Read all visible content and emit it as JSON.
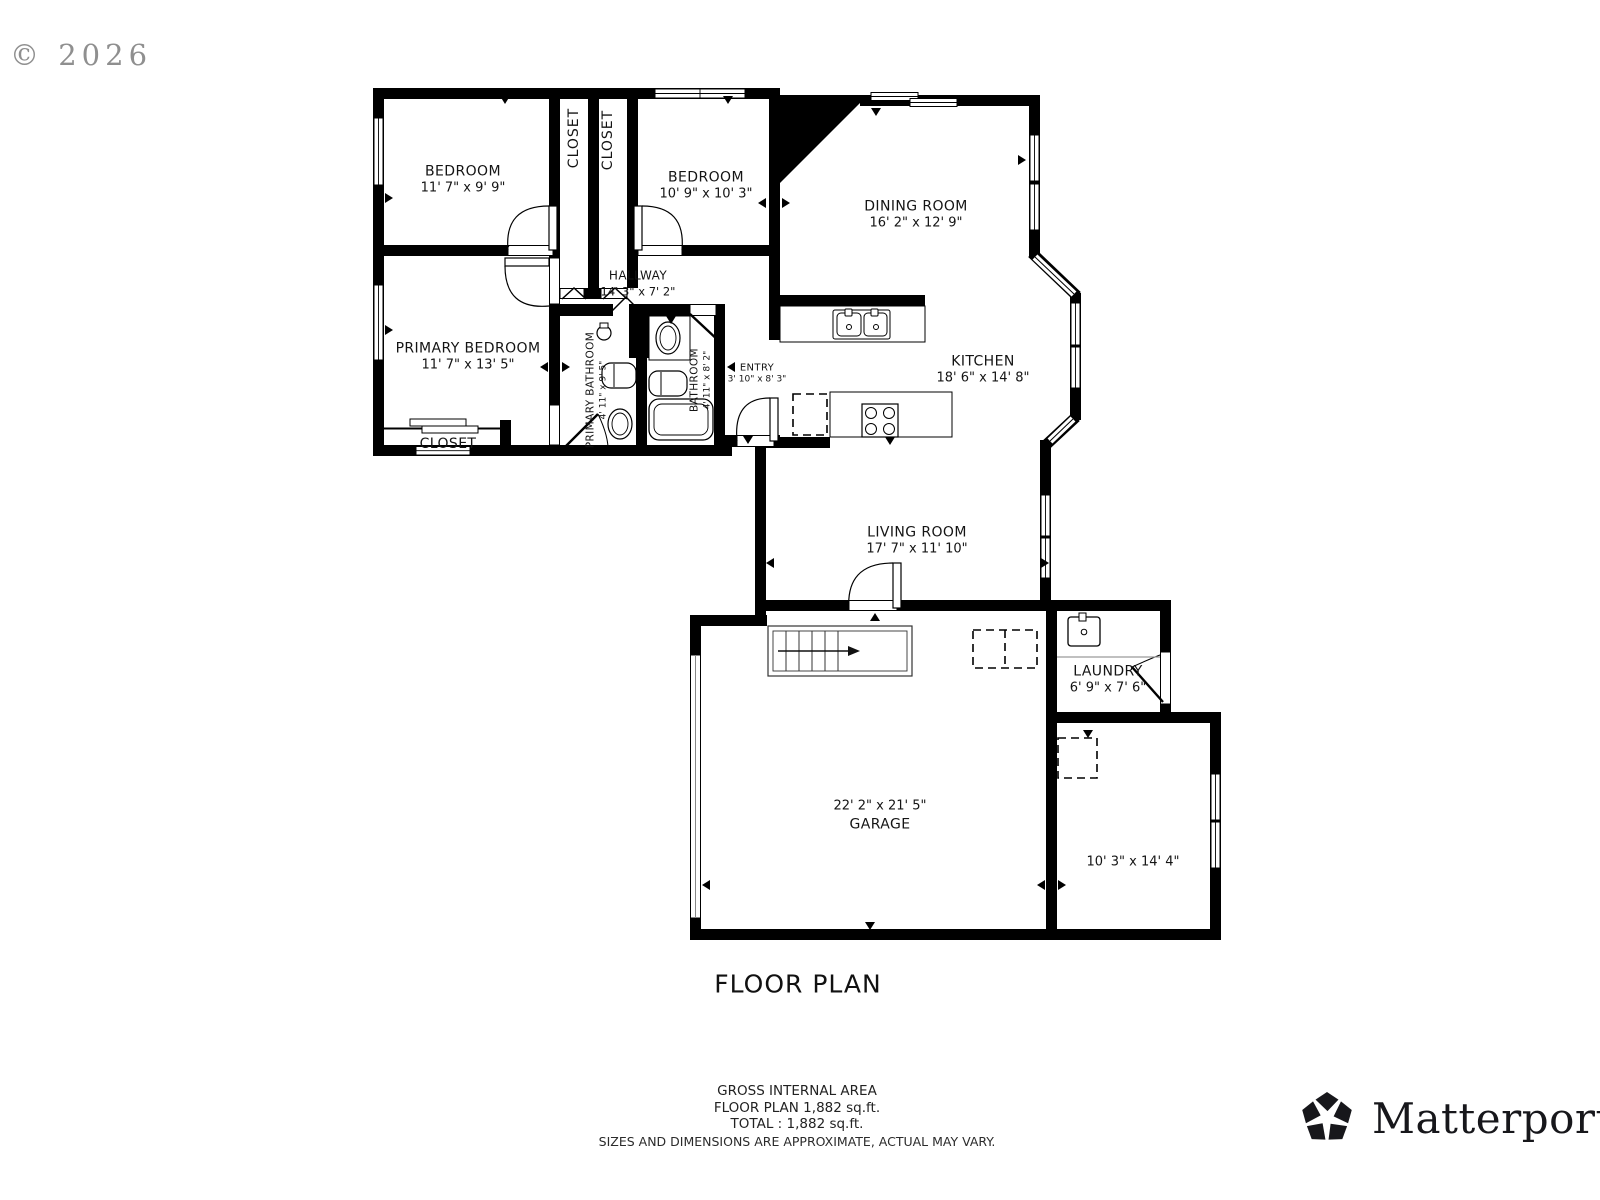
{
  "watermark": "© 2026",
  "title": "FLOOR PLAN",
  "rooms": {
    "bedroom1": {
      "name": "BEDROOM",
      "dims": "11' 7\" x 9' 9\""
    },
    "bedroom2": {
      "name": "BEDROOM",
      "dims": "10' 9\" x 10' 3\""
    },
    "closet1": {
      "name": "CLOSET"
    },
    "closet2": {
      "name": "CLOSET"
    },
    "dining": {
      "name": "DINING ROOM",
      "dims": "16' 2\" x 12' 9\""
    },
    "hallway": {
      "name": "HALLWAY",
      "dims": "14' 3\" x 7' 2\""
    },
    "primary_bedroom": {
      "name": "PRIMARY BEDROOM",
      "dims": "11' 7\" x 13' 5\""
    },
    "primary_bathroom": {
      "name": "PRIMARY BATHROOM",
      "dims": "4' 11\" x 9' 5\""
    },
    "bathroom": {
      "name": "BATHROOM",
      "dims": "4' 11\" x 8' 2\""
    },
    "entry": {
      "name": "ENTRY",
      "dims": "3' 10\" x 8' 3\""
    },
    "kitchen": {
      "name": "KITCHEN",
      "dims": "18' 6\" x 14' 8\""
    },
    "primary_closet": {
      "name": "CLOSET"
    },
    "living": {
      "name": "LIVING ROOM",
      "dims": "17' 7\" x 11' 10\""
    },
    "laundry": {
      "name": "LAUNDRY",
      "dims": "6' 9\" x 7' 6\""
    },
    "garage": {
      "name": "GARAGE",
      "dims": "22' 2\" x 21' 5\""
    },
    "bonus_room": {
      "dims": "10' 3\" x 14' 4\""
    }
  },
  "footer": {
    "line1": "GROSS INTERNAL AREA",
    "line2": "FLOOR PLAN 1,882 sq.ft.",
    "line3": "TOTAL :  1,882 sq.ft.",
    "disclaimer": "SIZES AND DIMENSIONS ARE APPROXIMATE, ACTUAL MAY VARY."
  },
  "brand": {
    "name": "Matterport",
    "reg": "®"
  },
  "colors": {
    "wall": "#000000",
    "label": "#141414",
    "watermark": "#8f8f8f",
    "brand": "#17171b"
  }
}
